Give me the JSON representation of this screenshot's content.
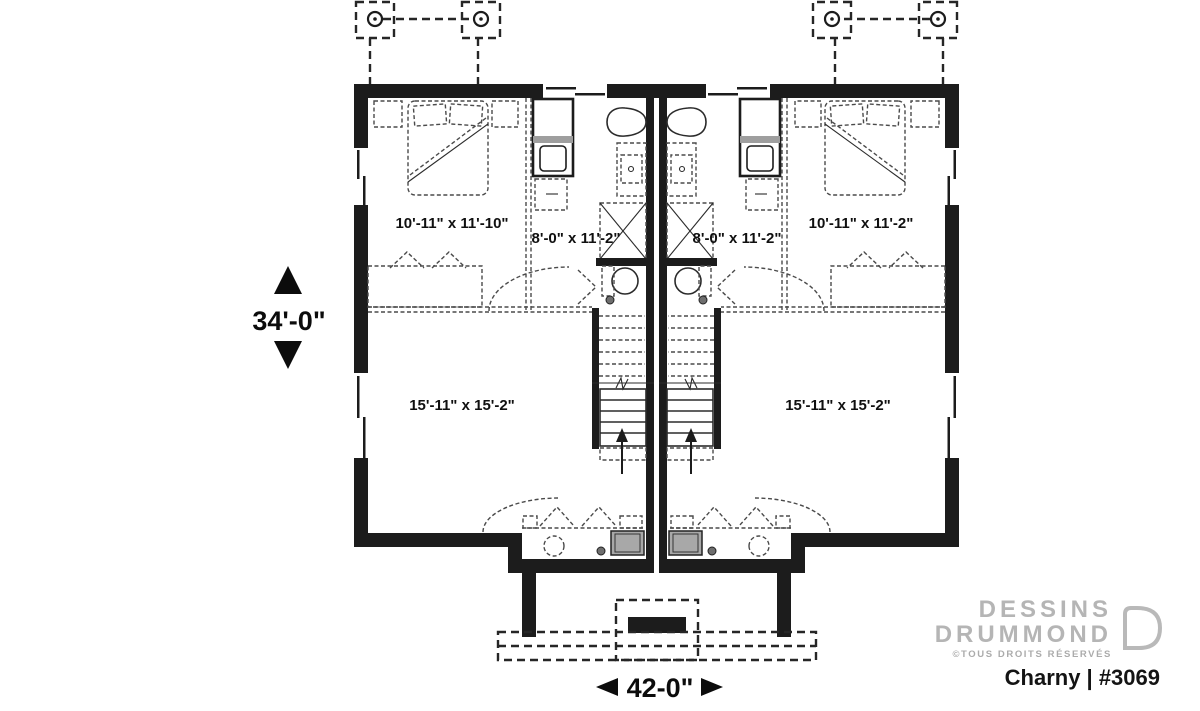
{
  "dimensions": {
    "height_label": "34'-0\"",
    "width_label": "42-0\""
  },
  "rooms": {
    "bedroom_left": "10'-11\" x 11'-10\"",
    "bath_left": "8'-0\" x 11'-2\"",
    "bath_right": "8'-0\" x 11'-2\"",
    "bedroom_right": "10'-11\" x 11'-2\"",
    "family_left": "15'-11\" x 15'-2\"",
    "family_right": "15'-11\" x 15'-2\""
  },
  "branding": {
    "name_line1": "DESSINS",
    "name_line2": "DRUMMOND",
    "rights": "©TOUS DROITS RÉSERVÉS",
    "plan_id": "Charny | #3069"
  },
  "colors": {
    "wall": "#1c1c1c",
    "dashed_line": "#4a4a4a",
    "appliance_fill": "#a8a8a8",
    "brand_gray": "#b5b5b5",
    "label_text": "#101010",
    "background": "#ffffff"
  }
}
